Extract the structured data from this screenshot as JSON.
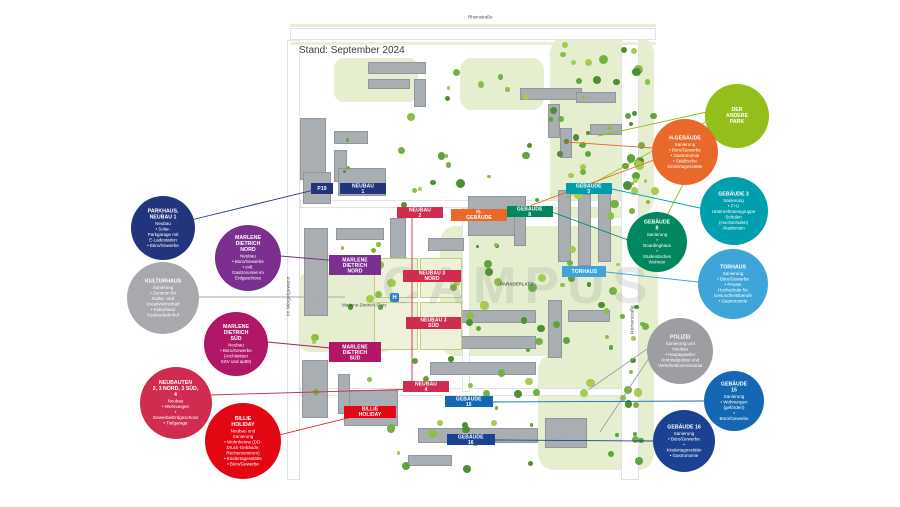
{
  "map": {
    "stand_label": "Stand: September 2024",
    "watermark": "CAMPUS",
    "plaza_label": "PARADEPLATZ",
    "platz_label": "Marlene-Dietrich-Platz",
    "transit_icon_glyph": "H",
    "streets": {
      "top": "Rheinstraße",
      "left": "Im Mörgelgewann",
      "right": "Römerstraße"
    },
    "chips": [
      {
        "id": "p19",
        "label": "P19",
        "color": "#21347C"
      },
      {
        "id": "neubau-1",
        "label": "NEUBAU 1",
        "color": "#21347C"
      },
      {
        "id": "neubau-2",
        "label": "NEUBAU 2",
        "color": "#D02C4F"
      },
      {
        "id": "h-gebaeude",
        "label": "H-GEBÄUDE",
        "color": "#E8692A"
      },
      {
        "id": "gebaeude-3",
        "label": "GEBÄUDE 3",
        "color": "#009FAE"
      },
      {
        "id": "gebaeude-8",
        "label": "GEBÄUDE 8",
        "color": "#00875F"
      },
      {
        "id": "marlene-dietrich-nord",
        "label": "MARLENE\nDIETRICH NORD",
        "color": "#7B2F8F"
      },
      {
        "id": "neubau-3-nord",
        "label": "NEUBAU 3 NORD",
        "color": "#D02C4F"
      },
      {
        "id": "neubau-3-sued",
        "label": "NEUBAU 3 SÜD",
        "color": "#D02C4F"
      },
      {
        "id": "marlene-dietrich-sued",
        "label": "MARLENE\nDIETRICH SÜD",
        "color": "#B01767"
      },
      {
        "id": "torhaus",
        "label": "TORHAUS",
        "color": "#3EA5D8"
      },
      {
        "id": "neubau-4",
        "label": "NEUBAU 4",
        "color": "#D02C4F"
      },
      {
        "id": "gebaeude-15",
        "label": "GEBÄUDE 15",
        "color": "#1467B3"
      },
      {
        "id": "billie-holiday",
        "label": "BILLIE HOLIDAY",
        "color": "#E30613"
      },
      {
        "id": "gebaeude-16",
        "label": "GEBÄUDE 16",
        "color": "#1B4193"
      }
    ]
  },
  "bubbles": [
    {
      "id": "parkhaus-neubau-1",
      "title": "PARKHAUS,\nNEUBAU 1",
      "color": "#21347C",
      "lines": [
        "Neubau",
        "• Solar-Parkgarage mit E-Ladestation",
        "• Büro/Gewerbe"
      ]
    },
    {
      "id": "marlene-dietrich-nord",
      "title": "MARLENE\nDIETRICH NORD",
      "color": "#7B2F8F",
      "lines": [
        "Neubau",
        "• Büro/Gewerbe",
        "• evtl. Gastronomie im Erdgeschoss"
      ]
    },
    {
      "id": "kulturhaus",
      "title": "KULTURHAUS",
      "color": "#A7A9AC",
      "lines": [
        "Sanierung",
        "• Zentrum für Kultur- und Kreativwirtschaft",
        "• Kulturhaus Karlstorbahnhof"
      ]
    },
    {
      "id": "marlene-dietrich-sued",
      "title": "MARLENE\nDIETRICH SÜD",
      "color": "#B01767",
      "lines": [
        "Neubau",
        "• Büro/Gewerbe",
        "(Architekten SSV und ap88)"
      ]
    },
    {
      "id": "neubauten",
      "title": "NEUBAUTEN\n2, 3 NORD, 3 SÜD, 4",
      "color": "#D02C4F",
      "lines": [
        "Neubau",
        "• Wohnungen",
        "• Gewerbe/Erdgeschoss",
        "• Tiefgarage"
      ]
    },
    {
      "id": "billie-holiday",
      "title": "BILLIE HOLIDAY",
      "color": "#E30613",
      "lines": [
        "Neubau und Sanierung",
        "• Wohnheime (DD-Druck-Gebäude; Rechenzentrum)",
        "• Kindertagesstätte",
        "• Büro/Gewerbe"
      ]
    },
    {
      "id": "der-andere-park",
      "title": "DER ANDERE\nPARK",
      "color": "#94BE1A",
      "lines": []
    },
    {
      "id": "h-gebaeude",
      "title": "H-GEBÄUDE",
      "color": "#E8692A",
      "lines": [
        "Sanierung",
        "• Büro/Gewerbe",
        "• Gastronomie",
        "• Städtische Kindertagesstätte"
      ]
    },
    {
      "id": "gebaeude-3",
      "title": "GEBÄUDE 3",
      "color": "#009FAE",
      "lines": [
        "Sanierung",
        "• F+U Unternehmensgruppe",
        "Schulen (Hochschulen)",
        "Akademien"
      ]
    },
    {
      "id": "gebaeude-8",
      "title": "GEBÄUDE 8",
      "color": "#00875F",
      "lines": [
        "Sanierung",
        "• Boardinghaus",
        "• Studentisches Wohnen"
      ]
    },
    {
      "id": "torhaus",
      "title": "TORHAUS",
      "color": "#3EA5D8",
      "lines": [
        "Sanierung",
        "• Büro/Gewerbe",
        "• Private Hochschule für Gesundheitsberufe",
        "• Gastronomie"
      ]
    },
    {
      "id": "polizei",
      "title": "POLIZEI",
      "color": "#9C9EA1",
      "lines": [
        "Sanierung und Neubau",
        "• Hauptquartier Kriminalpolizei und Verkehrskommissariat"
      ]
    },
    {
      "id": "gebaeude-15",
      "title": "GEBÄUDE 15",
      "color": "#1467B3",
      "lines": [
        "Sanierung",
        "• Wohnungen (gefördert)",
        "• Büro/Gewerbe"
      ]
    },
    {
      "id": "gebaeude-16",
      "title": "GEBÄUDE 16",
      "color": "#1B4193",
      "lines": [
        "Sanierung",
        "• Büro/Gewerbe",
        "• Kindertagesstätte",
        "• Gastronomie"
      ]
    }
  ]
}
